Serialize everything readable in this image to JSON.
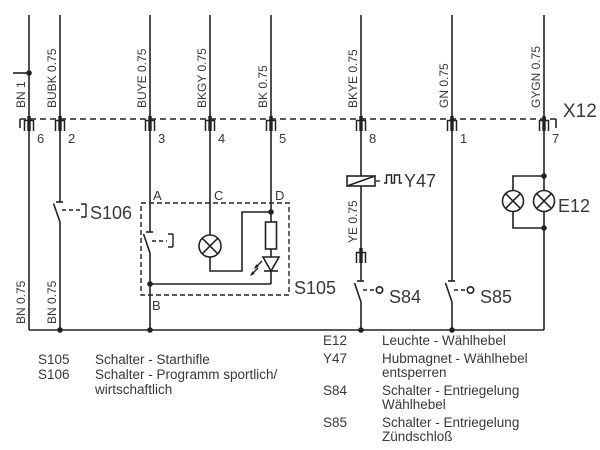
{
  "connector": {
    "label": "X12"
  },
  "wires": [
    {
      "top_label": "BN 1",
      "pin": "6",
      "bottom_label": "BN 0.75"
    },
    {
      "top_label": "BUBK 0.75",
      "pin": "2",
      "bottom_label": "BN 0.75"
    },
    {
      "top_label": "BUYE 0.75",
      "pin": "3"
    },
    {
      "top_label": "BKGY 0.75",
      "pin": "4"
    },
    {
      "top_label": "BK 0.75",
      "pin": "5"
    },
    {
      "top_label": "BKYE 0.75",
      "pin": "8",
      "mid_label": "YE 0.75"
    },
    {
      "top_label": "GN 0.75",
      "pin": "1"
    },
    {
      "top_label": "GYGN 0.75",
      "pin": "7"
    }
  ],
  "components": {
    "s105": {
      "label": "S105",
      "terminal_a": "A",
      "terminal_b": "B",
      "terminal_c": "C",
      "terminal_d": "D"
    },
    "s106": {
      "label": "S106"
    },
    "y47": {
      "label": "Y47"
    },
    "s84": {
      "label": "S84"
    },
    "s85": {
      "label": "S85"
    },
    "e12": {
      "label": "E12"
    }
  },
  "legend": {
    "left": [
      {
        "id": "S105",
        "line1": "Schalter - Starthifle",
        "line2": ""
      },
      {
        "id": "S106",
        "line1": "Schalter - Programm sportlich/",
        "line2": "wirtschaftlich"
      }
    ],
    "right": [
      {
        "id": "E12",
        "line1": "Leuchte - Wählhebel",
        "line2": ""
      },
      {
        "id": "Y47",
        "line1": "Hubmagnet - Wählhebel",
        "line2": "entsperren"
      },
      {
        "id": "S84",
        "line1": "Schalter - Entriegelung",
        "line2": "Wählhebel"
      },
      {
        "id": "S85",
        "line1": "Schalter - Entriegelung",
        "line2": "Zündschloß"
      }
    ]
  },
  "colors": {
    "line": "#222222",
    "text": "#383838",
    "background": "#ffffff"
  }
}
